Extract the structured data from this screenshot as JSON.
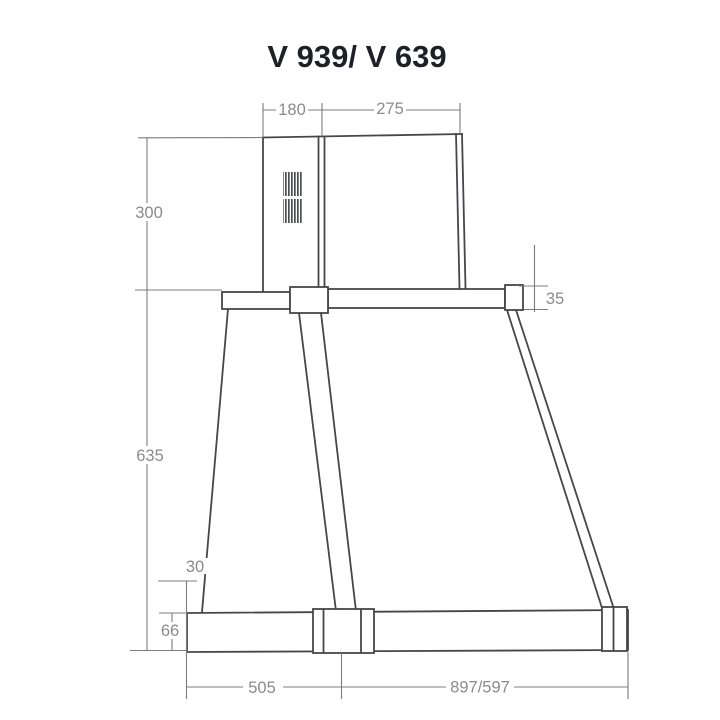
{
  "title": "V 939/ V 639",
  "colors": {
    "outline": "#45474a",
    "dimension": "#7c7c7c",
    "label_text": "#8b8b8b",
    "title_text": "#1d2126",
    "background": "#ffffff"
  },
  "dimensions": {
    "chimney_front_width": "180",
    "chimney_side_depth": "275",
    "chimney_height": "300",
    "top_frame_thickness": "35",
    "body_height": "635",
    "bottom_front_offset": "30",
    "bottom_frame_height": "66",
    "bottom_depth": "505",
    "bottom_width_variants": "897/597"
  }
}
